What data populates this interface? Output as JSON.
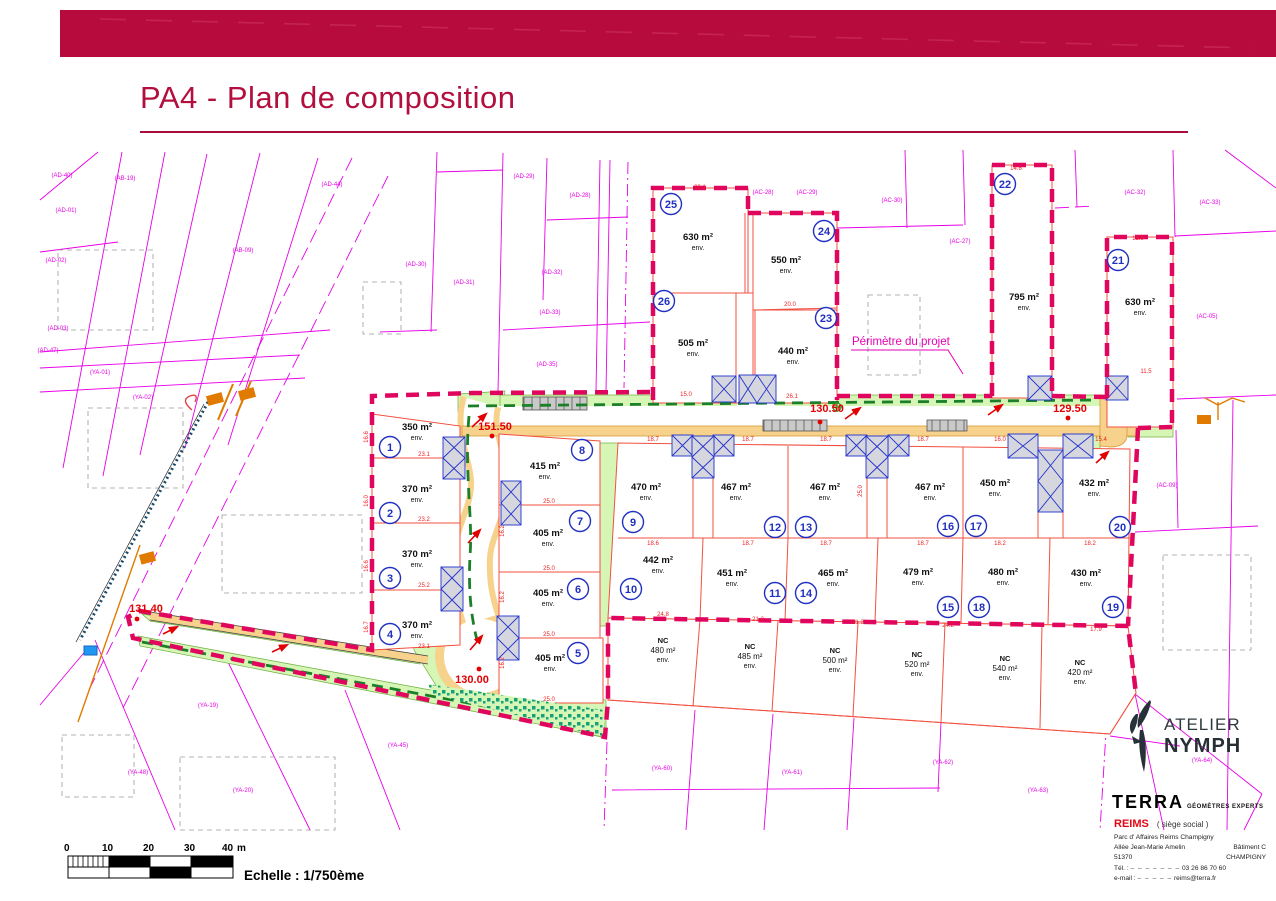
{
  "header": {
    "title": "PA4 - Plan de composition"
  },
  "map": {
    "perimeter_label": "Périmètre du projet",
    "env": "env.",
    "nc_label": "NC",
    "lots": [
      {
        "num": "1",
        "area": "350 m²"
      },
      {
        "num": "2",
        "area": "370 m²"
      },
      {
        "num": "3",
        "area": "370 m²"
      },
      {
        "num": "4",
        "area": "370 m²"
      },
      {
        "num": "5",
        "area": "405 m²"
      },
      {
        "num": "6",
        "area": "405 m²"
      },
      {
        "num": "7",
        "area": "405 m²"
      },
      {
        "num": "8",
        "area": "415 m²"
      },
      {
        "num": "9",
        "area": "470 m²"
      },
      {
        "num": "10",
        "area": "442 m²"
      },
      {
        "num": "11",
        "area": "451 m²"
      },
      {
        "num": "12",
        "area": "467 m²"
      },
      {
        "num": "13",
        "area": "467 m²"
      },
      {
        "num": "14",
        "area": "465 m²"
      },
      {
        "num": "15",
        "area": "479 m²"
      },
      {
        "num": "16",
        "area": "467 m²"
      },
      {
        "num": "17",
        "area": "450 m²"
      },
      {
        "num": "18",
        "area": "480 m²"
      },
      {
        "num": "19",
        "area": "430 m²"
      },
      {
        "num": "20",
        "area": "432 m²"
      },
      {
        "num": "21",
        "area": "630 m²"
      },
      {
        "num": "22",
        "area": "795 m²"
      },
      {
        "num": "23",
        "area": "440 m²"
      },
      {
        "num": "24",
        "area": "550 m²"
      },
      {
        "num": "25",
        "area": "630 m²"
      },
      {
        "num": "26",
        "area": "505 m²"
      }
    ],
    "nc_lots": [
      {
        "area": "480 m²"
      },
      {
        "area": "485 m²"
      },
      {
        "area": "500 m²"
      },
      {
        "area": "520 m²"
      },
      {
        "area": "540 m²"
      },
      {
        "area": "420 m²"
      }
    ],
    "measurements": {
      "m1": "151.50",
      "m2": "130.50",
      "m3": "129.50",
      "m4": "130.00",
      "m5": "131.40"
    },
    "dims": [
      "23.1",
      "23.2",
      "25.2",
      "23.1",
      "25.0",
      "25.0",
      "25.0",
      "25.0",
      "18.7",
      "18.7",
      "18.7",
      "18.7",
      "16.0",
      "15.4",
      "18.6",
      "18.7",
      "18.7",
      "18.7",
      "18.2",
      "18.2",
      "15.0",
      "26.1",
      "20.0",
      "23.1",
      "14.8",
      "15.9",
      "11.5",
      "24.8",
      "21.2",
      "21.2",
      "24.2",
      "17.9",
      "16.6",
      "16.0",
      "16.6",
      "16.7",
      "16.2",
      "16.2",
      "16.2",
      "25.0"
    ],
    "cadastral_labels": [
      "(AD-40)",
      "(AB-19)",
      "(AD-44)",
      "(AD-01)",
      "(AD-02)",
      "(AD-03)",
      "(AB-09)",
      "(YA-01)",
      "(YA-02)",
      "(AD-30)",
      "(AD-31)",
      "(AD-32)",
      "(AD-33)",
      "(AD-35)",
      "(AD-29)",
      "(AD-28)",
      "(AC-28)",
      "(AC-29)",
      "(AC-30)",
      "(AC-32)",
      "(AC-33)",
      "(AC-27)",
      "(AC-05)",
      "(AC-09)",
      "(YA-19)",
      "(YA-48)",
      "(YA-20)",
      "(YA-45)",
      "(YA-60)",
      "(YA-61)",
      "(YA-62)",
      "(YA-63)",
      "(YA-64)",
      "(AD-47)"
    ],
    "colors": {
      "banner": "#b60b3c",
      "cadastral_magenta": "#e800e8",
      "perimeter_pink": "#e0065e",
      "lot_red": "#f2503f",
      "green": "#d5f6b4",
      "road_tan": "#f6d28d",
      "marker_blue": "#2030c0",
      "dim_red": "#e30000"
    }
  },
  "scalebar": {
    "ticks": [
      "0",
      "10",
      "20",
      "30",
      "40"
    ],
    "unit": "m",
    "label": "Echelle : 1/750ème"
  },
  "footer": {
    "atelier": {
      "line1": "ATELIER",
      "line2": "NYMPH"
    },
    "terra": {
      "name": "TERRA",
      "subtitle": "GÉOMÈTRES EXPERTS"
    },
    "office": {
      "city": "REIMS",
      "hq": "( siège social )",
      "addr1": "Parc  d' Affaires  Reims  Champigny",
      "addr2_left": "Allée Jean-Marie Amelin",
      "addr2_right": "Bâtiment C",
      "addr3_left": "51370",
      "addr3_right": "CHAMPIGNY",
      "tel_label": "Tél. :",
      "tel_mask": "– – – – – – –",
      "tel": "03 26 86 70 60",
      "email_label": "e-mail :",
      "email_mask": "– – – – –",
      "email": "reims@terra.fr"
    }
  }
}
